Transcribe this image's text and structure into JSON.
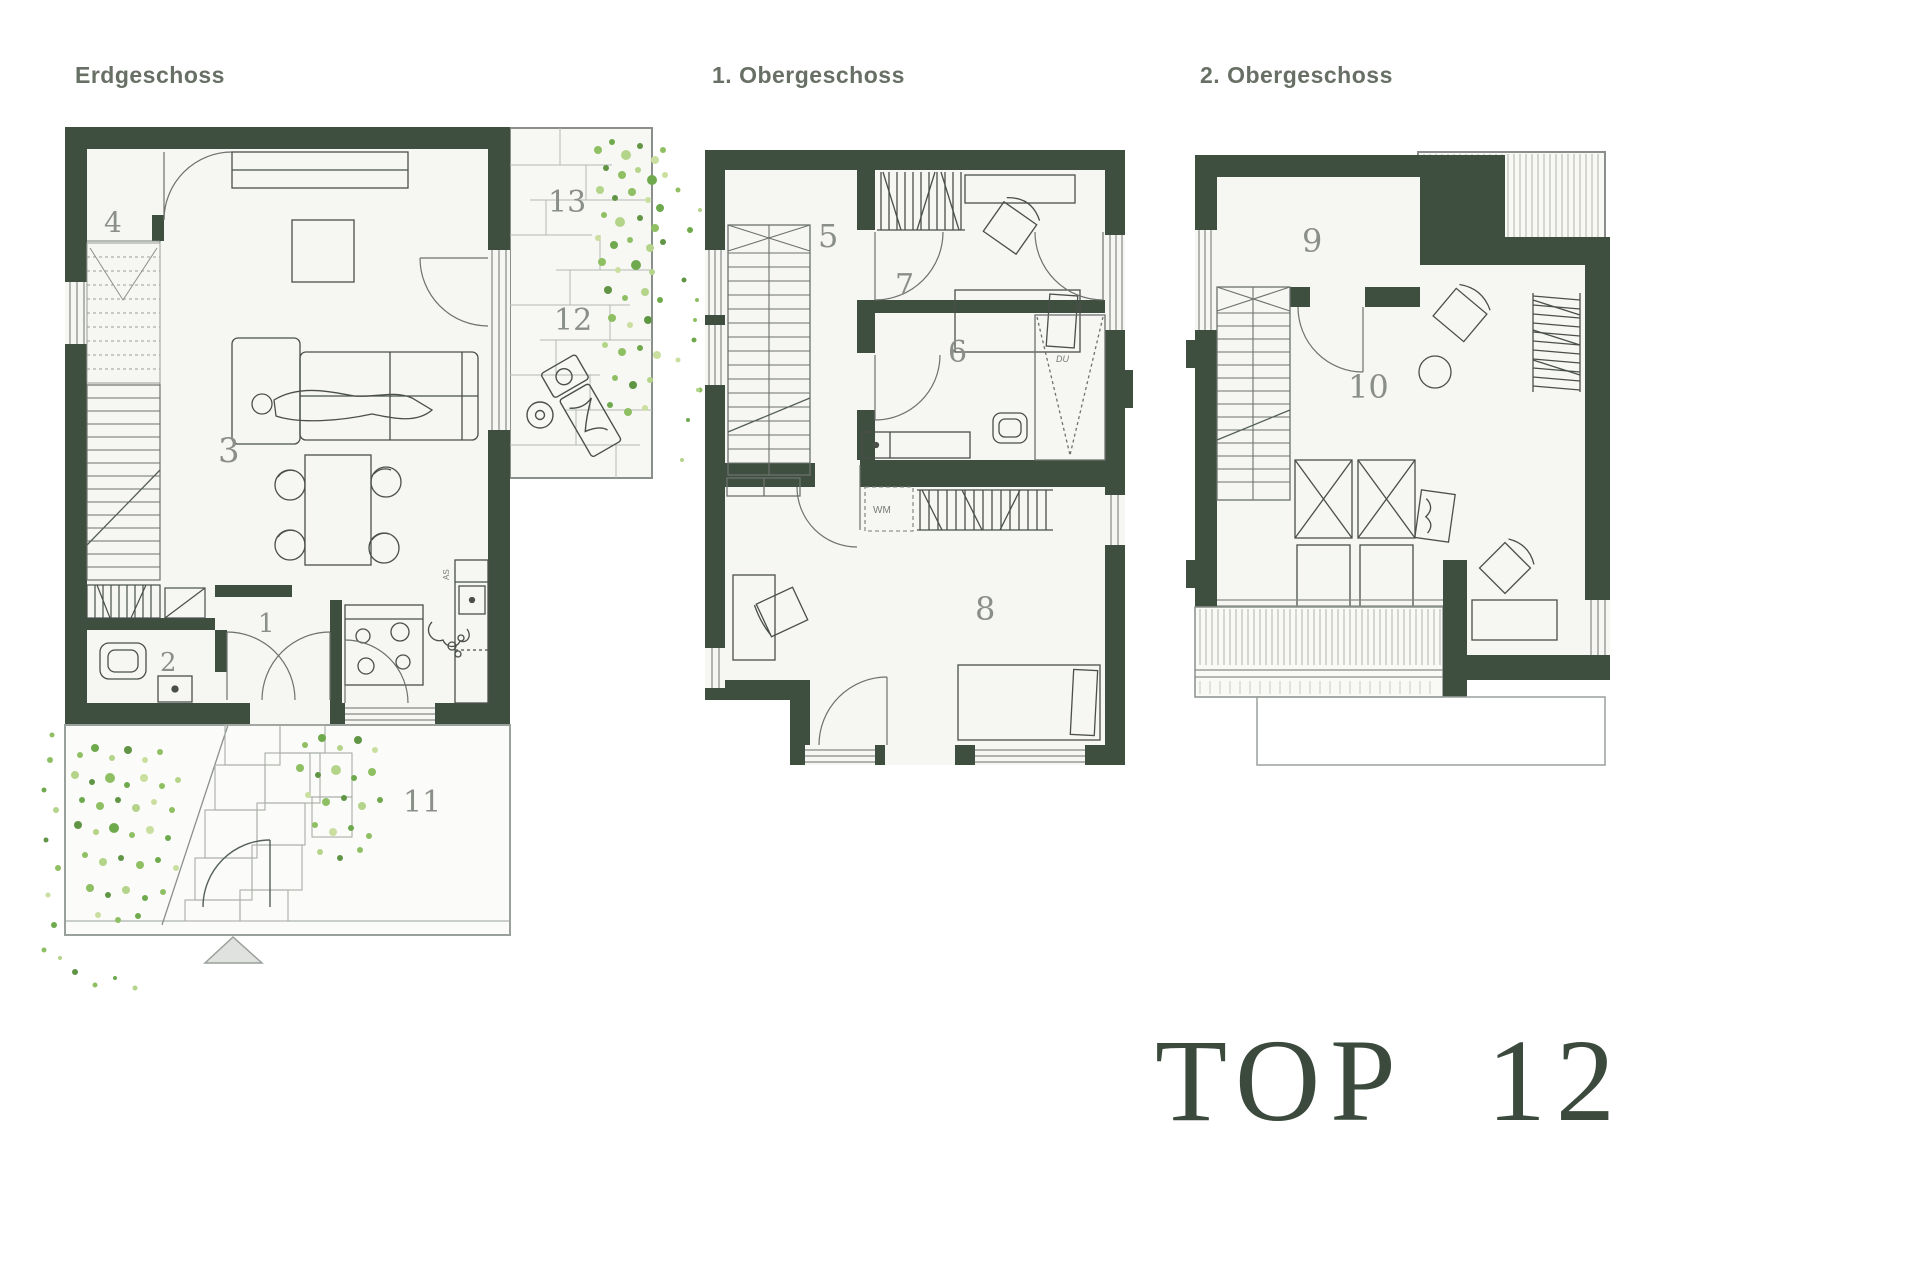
{
  "branding": {
    "unit_label": "TOP 12"
  },
  "colors": {
    "wall": "#3e4e3f",
    "floor": "#f6f6f3",
    "furniture_line": "#4a4f4a",
    "paving_line": "#aeb3ae",
    "title_text": "#687066",
    "room_number_text": "#8b8f8a",
    "unit_label_text": "#3b4a3c",
    "vegetation_greens": [
      "#8fbf63",
      "#6fa94e",
      "#b4d489",
      "#5f9544",
      "#cadf9f"
    ]
  },
  "plans": [
    {
      "title": "Erdgeschoss",
      "rooms": [
        {
          "number": "4"
        },
        {
          "number": "3"
        },
        {
          "number": "2"
        },
        {
          "number": "1"
        },
        {
          "number": "13"
        },
        {
          "number": "12"
        },
        {
          "number": "11"
        }
      ],
      "labels": [
        {
          "text": "AS"
        }
      ]
    },
    {
      "title": "1. Obergeschoss",
      "rooms": [
        {
          "number": "5"
        },
        {
          "number": "7"
        },
        {
          "number": "6"
        },
        {
          "number": "8"
        }
      ],
      "labels": [
        {
          "text": "WM"
        },
        {
          "text": "DU"
        }
      ]
    },
    {
      "title": "2. Obergeschoss",
      "rooms": [
        {
          "number": "9"
        },
        {
          "number": "10"
        }
      ],
      "labels": []
    }
  ]
}
